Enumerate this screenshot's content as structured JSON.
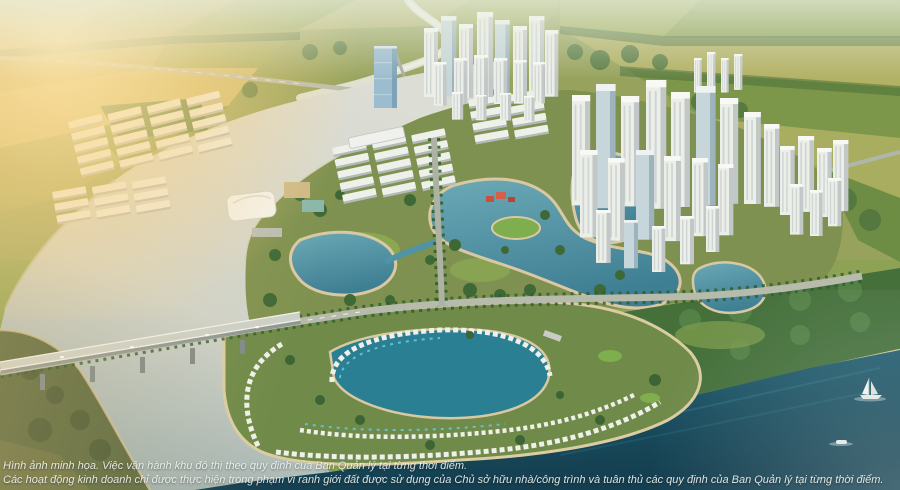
{
  "image": {
    "kind": "aerial-masterplan-render",
    "description": "Aerial rendering of a riverside smart-city township: farmland horizon, winding river, white high-rise clusters, shophouse grids, turquoise lagoons, tree-lined boulevard, highway bridge, waterfront villa peninsula and a dark river with boats in the foreground"
  },
  "disclaimer": {
    "line1": "Hình ảnh minh họa. Việc vận hành khu đô thị theo quy định của Ban Quản lý tại từng thời điểm.",
    "line2": "Các hoạt động kinh doanh chỉ được thực hiện trong phạm vi ranh giới đất được sử dụng của Chủ sở hữu nhà/công trình và tuân thủ các quy định của Ban Quản lý tại từng thời điểm."
  },
  "palette": {
    "farmland_gold": "#cabd72",
    "farmland_green": "#8da24f",
    "treeline": "#4a6f3a",
    "river_light": "#dcddd4",
    "river_shaded": "#9fb0ac",
    "sea_dark": "#16475a",
    "lagoon": "#528ea1",
    "lagoon_shallow": "#8ec4cc",
    "beach_sand": "#d9c9a2",
    "tower_white": "#eceee8",
    "tower_blue_glass": "#9cbdd0",
    "park_green": "#7f9150",
    "forest": "#45703a",
    "road": "#b7bbac",
    "sun_glow": "#ffe9af",
    "text": "#eef2ee"
  },
  "scene_elements": [
    "farmland-patchwork",
    "winding-creek",
    "elevated-highway",
    "metro-viaduct",
    "light-river",
    "high-rise-cluster-north",
    "blue-glass-tower",
    "high-rise-cluster-east",
    "high-rise-cluster-far-east",
    "shophouse-grids",
    "sales-gallery",
    "sports-courts",
    "central-lagoon",
    "lawn-island",
    "red-pavilion",
    "tree-lined-boulevard",
    "main-artery",
    "highway-bridge",
    "villa-peninsula",
    "inner-lagoon",
    "forest-park",
    "dark-river",
    "sailing-yacht",
    "speedboat"
  ]
}
